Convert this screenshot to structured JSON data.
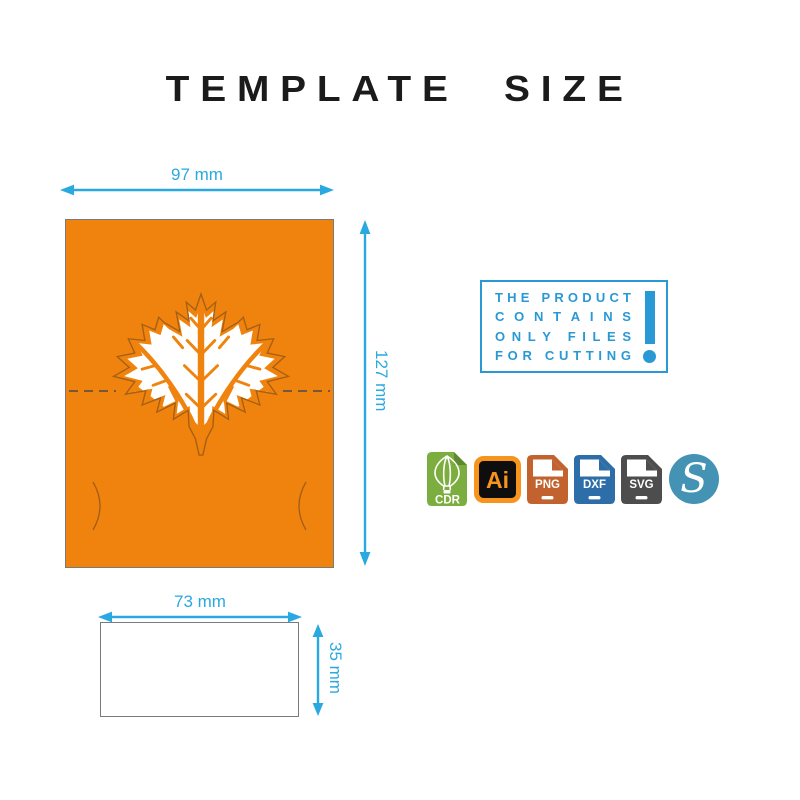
{
  "title": "TEMPLATE SIZE",
  "dimensions": {
    "card_width": "97 mm",
    "card_height": "127 mm",
    "insert_width": "73 mm",
    "insert_height": "35 mm"
  },
  "notice": {
    "line1": "THE PRODUCT",
    "line2": "CONTAINS",
    "line3": "ONLY FILES",
    "line4": "FOR CUTTING",
    "exclamation": "!"
  },
  "formats": {
    "cdr": "CDR",
    "ai": "Ai",
    "png": "PNG",
    "dxf": "DXF",
    "svg": "SVG",
    "silhouette": "S"
  },
  "colors": {
    "card_orange": "#F0830D",
    "leaf_outline_brown": "#A55F15",
    "dimension_cyan": "#2AA9E0",
    "notice_blue": "#2999D6",
    "cdr_green": "#7CAD3F",
    "ai_orange": "#F7941E",
    "png_terracotta": "#C2632F",
    "dxf_blue": "#2D6DA8",
    "svg_gray": "#4D4D4D",
    "silhouette_teal": "#4493B4",
    "title_black": "#1B1B1B"
  }
}
